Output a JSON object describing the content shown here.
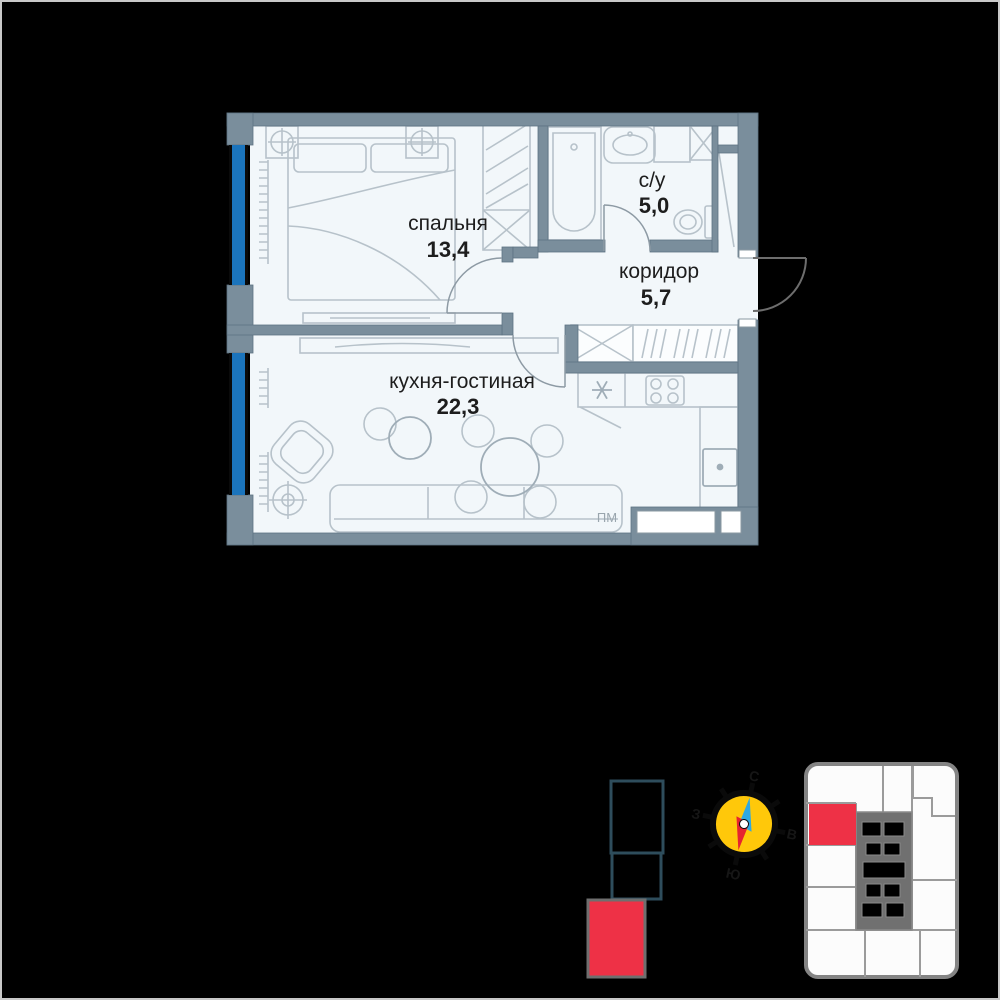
{
  "plan": {
    "rooms": {
      "bedroom": {
        "name": "спальня",
        "area": "13,4"
      },
      "bathroom": {
        "name": "с/у",
        "area": "5,0"
      },
      "corridor": {
        "name": "коридор",
        "area": "5,7"
      },
      "kitchen": {
        "name": "кухня-гостиная",
        "area": "22,3"
      }
    },
    "labels": {
      "dishwasher": "ПМ"
    }
  },
  "compass": {
    "north": "С",
    "east": "В",
    "south": "Ю",
    "west": "З"
  },
  "colors": {
    "wall": "#7a8e9c",
    "floor": "#f2f7fa",
    "window_glass": "#1b74bc",
    "highlight_red": "#ee3146",
    "compass_yellow": "#ffc80a",
    "needle_blue": "#2fa8e1",
    "needle_red": "#e62330",
    "section_outline": "#2e4d5c",
    "keyplan_core": "#707070"
  }
}
